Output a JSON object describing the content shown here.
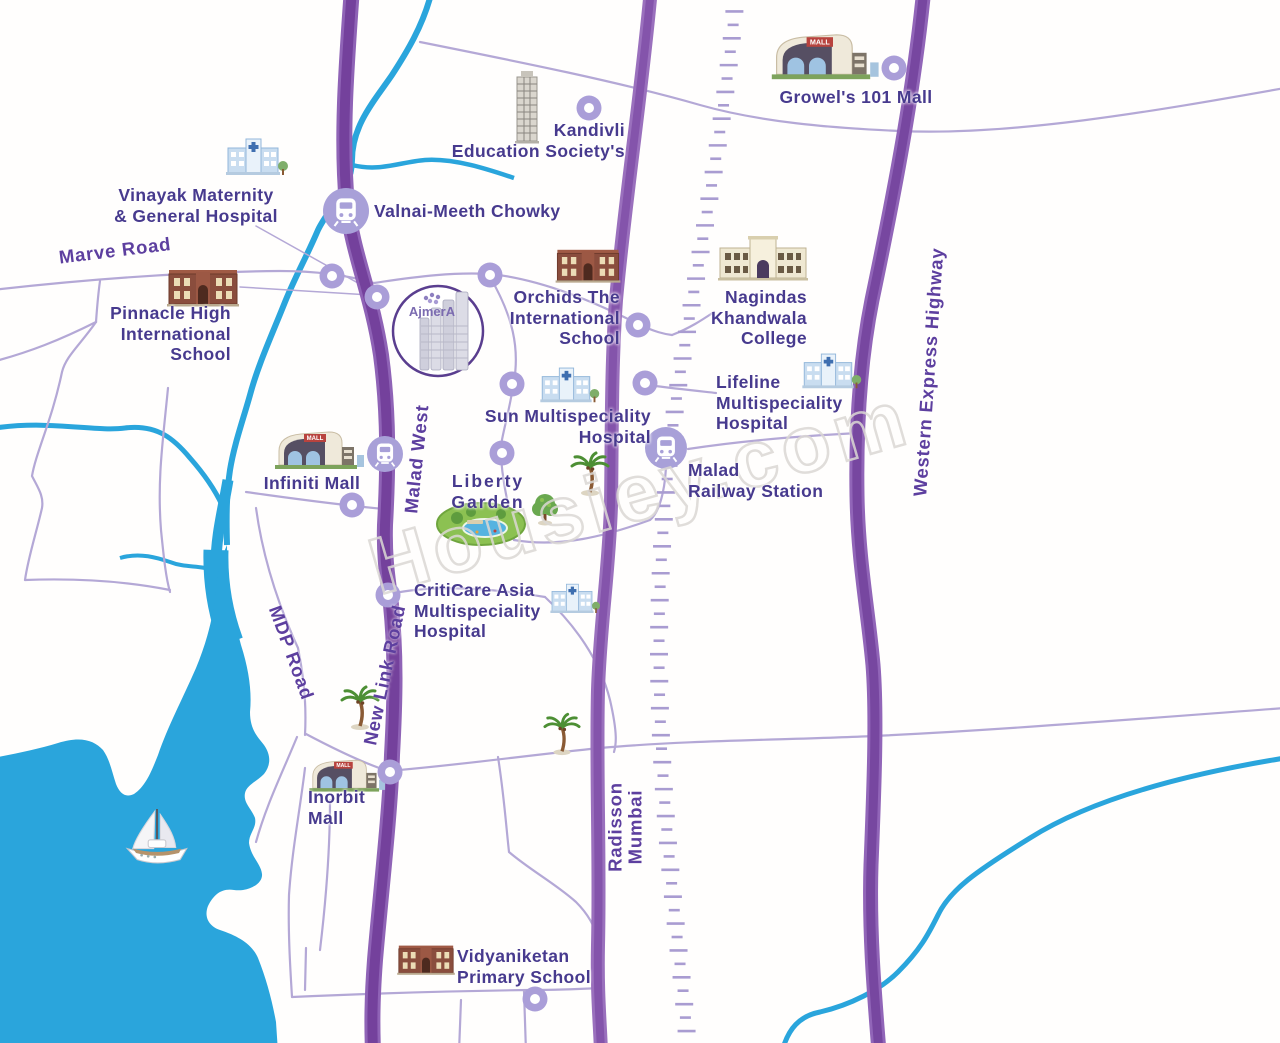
{
  "watermark": "Housiey.com",
  "project": {
    "name": "AjmerA"
  },
  "icons": {
    "mall_sign": "MALL"
  },
  "landmarks": {
    "kandivli": "Kandivli\nEducation Society's",
    "growels": "Growel's 101 Mall",
    "vinayak": "Vinayak Maternity\n& General Hospital",
    "valnai": "Valnai-Meeth Chowky",
    "pinnacle": "Pinnacle High\nInternational\nSchool",
    "orchids": "Orchids The\nInternational\nSchool",
    "nagindas": "Nagindas\nKhandwala\nCollege",
    "sun": "Sun Multispeciality\nHospital",
    "lifeline": "Lifeline\nMultispeciality\nHospital",
    "malad_station": "Malad\nRailway Station",
    "infiniti": "Infiniti Mall",
    "liberty": "Liberty\nGarden",
    "criticare": "CritiCare Asia\nMultispeciality\nHospital",
    "inorbit": "Inorbit\nMall",
    "vidyaniketan": "Vidyaniketan\nPrimary School"
  },
  "roads": {
    "marve": "Marve Road",
    "malad_west": "Malad West",
    "new_link": "New Link Road",
    "mdp": "MDP Road",
    "radisson": "Radisson\nMumbai",
    "weh": "Western Express Highway"
  },
  "colors": {
    "road_major": "#7b47a3",
    "road_major_edge": "#9165b8",
    "road_minor": "#b4a8d6",
    "railway": "#a99cd1",
    "water": "#2aa5dc",
    "label_text": "#473a8e",
    "road_label_text": "#5d3f9f",
    "marker": "#aa9ed8",
    "watermark": "#dbd8d4"
  }
}
